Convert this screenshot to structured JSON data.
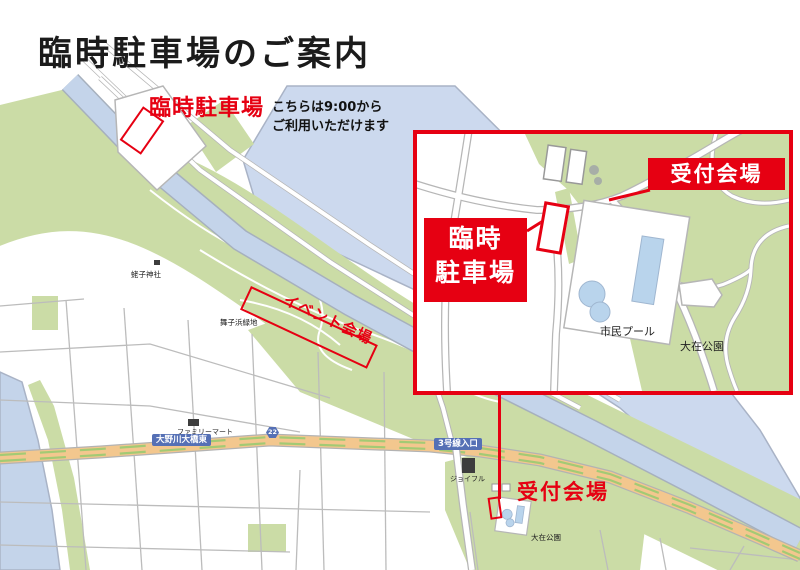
{
  "title": "臨時駐車場のご案内",
  "colors": {
    "accent_red": "#e60012",
    "water_blue": "#c4d4ea",
    "park_green": "#cbdca6",
    "road_orange": "#f3c78e",
    "sign_blue": "#5570b5"
  },
  "main_map": {
    "parking_label": "臨時駐車場",
    "parking_note_line1": "こちらは9:00から",
    "parking_note_line2": "ご利用いただけます",
    "event_area_label": "イベント会場",
    "reception_label": "受付会場",
    "shrine_label": "蛯子神社",
    "greenspace_label": "舞子浜緑地",
    "familymart_label": "ファミリーマート",
    "bridge_label": "大野川大橋東",
    "route_shield_number": "22",
    "route3_label": "3号線入口",
    "joyful_label": "ジョイフル",
    "park_label": "大在公園"
  },
  "inset": {
    "reception_label": "受付会場",
    "parking_line1": "臨時",
    "parking_line2": "駐車場",
    "pool_label": "市民プール",
    "park_label": "大在公園"
  }
}
